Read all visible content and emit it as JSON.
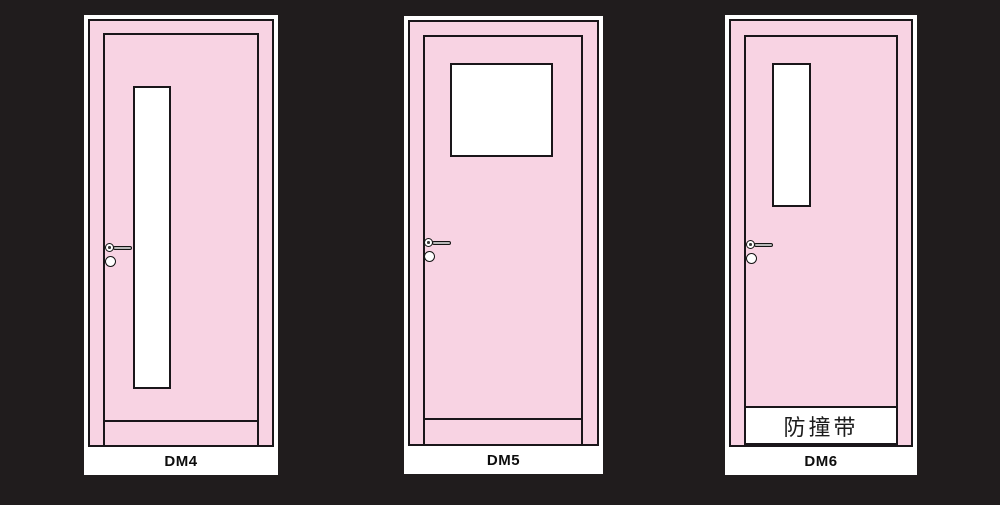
{
  "diagram_title": "door-model-elevations",
  "colors": {
    "background": "#201C1D",
    "door_fill": "#F8D3E3",
    "outline": "#1A161A",
    "frame_and_glass": "#FFFFFF",
    "lever_fill": "#B8B8B8",
    "label_text": "#0D0D0D"
  },
  "doors": [
    {
      "label": "DM4"
    },
    {
      "label": "DM5"
    },
    {
      "label": "DM6",
      "bump_strip_label": "防撞带"
    }
  ]
}
